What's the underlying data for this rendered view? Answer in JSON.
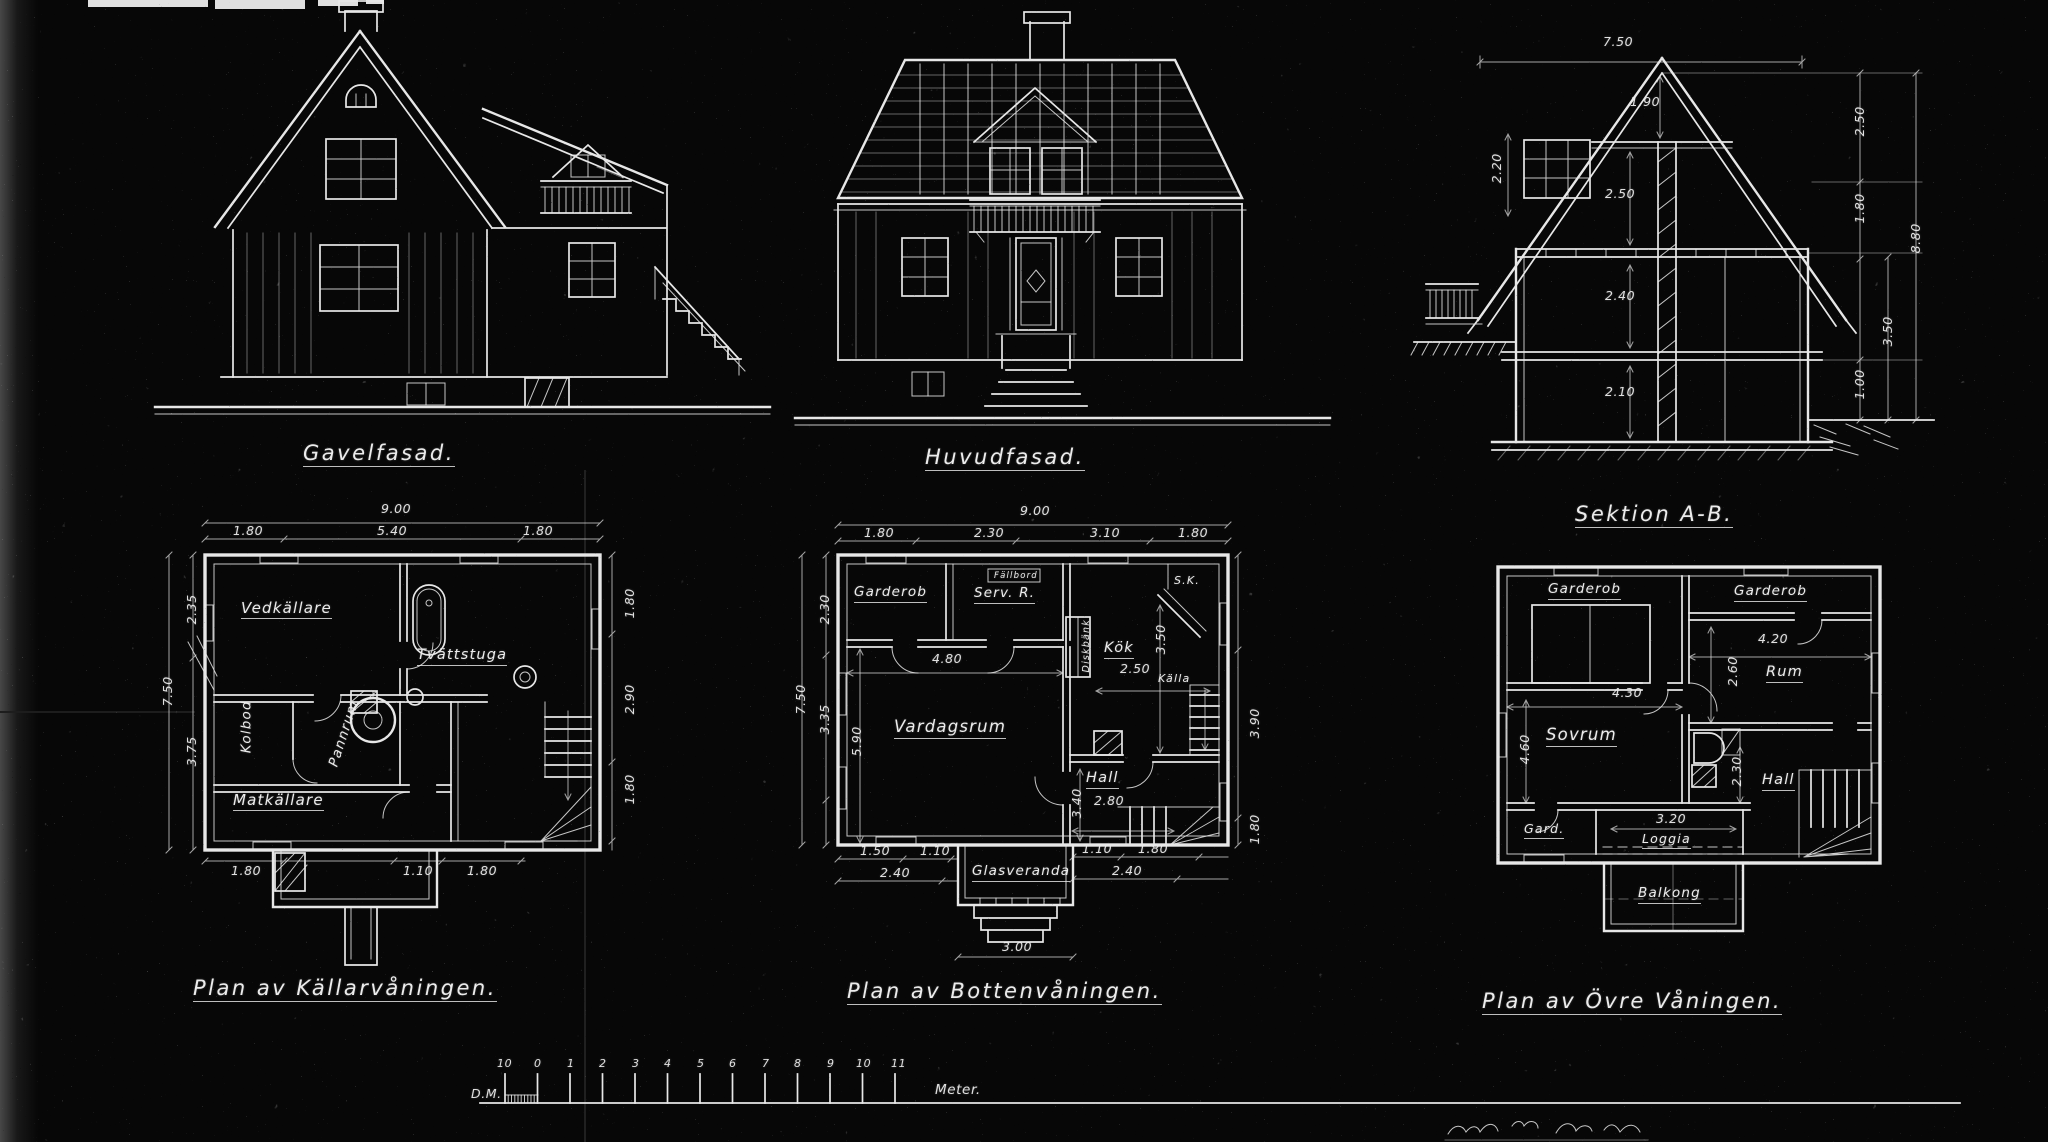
{
  "meta": {
    "description": "Scanned architectural blueprint, photographic negative (white line work on black paper)",
    "ink_color": "#e7e7e7",
    "paper_color": "#070707"
  },
  "elevations": {
    "gavelfasad": {
      "title": "Gavelfasad."
    },
    "huvudfasad": {
      "title": "Huvudfasad."
    },
    "sektion": {
      "title": "Sektion A-B.",
      "dims": {
        "top": "7.50",
        "ridge": "1.90",
        "attic": "2.50",
        "left": "2.20",
        "floor1": "2.40",
        "cellar": "2.10",
        "r1": "2.50",
        "r2": "1.80",
        "r3": "1.00",
        "r4": "3.50",
        "total": "8.80"
      }
    }
  },
  "plans": {
    "cellar": {
      "title": "Plan av Källarvåningen.",
      "rooms": {
        "vedkallare": "Vedkällare",
        "tvattstuga": "Tvättstuga",
        "kolbod": "Kolbod",
        "pannrum": "Pannrum",
        "matkallare": "Matkällare"
      },
      "dims": {
        "w": "9.00",
        "w1": "1.80",
        "w2": "5.40",
        "w3": "1.80",
        "h": "7.50",
        "l1": "2.35",
        "l2": "3.75",
        "r1": "1.80",
        "r2": "2.90",
        "r3": "1.80",
        "b1": "1.80",
        "b2": "1.10",
        "b3": "1.80"
      }
    },
    "ground": {
      "title": "Plan av Bottenvåningen.",
      "rooms": {
        "garderob": "Garderob",
        "serv": "Serv. R.",
        "sk": "S.K.",
        "kok": "Kök",
        "vardagsrum": "Vardagsrum",
        "hall": "Hall",
        "kalla": "Källa",
        "glasveranda": "Glasveranda",
        "diskbank": "Diskbänk",
        "fallbord": "Fällbord"
      },
      "dims": {
        "w": "9.00",
        "t1": "1.80",
        "t2": "2.30",
        "t3": "3.10",
        "t4": "1.80",
        "vard_w": "4.80",
        "vard_h": "5.90",
        "kok": "2.50",
        "kok_h": "3.50",
        "hall_w": "2.80",
        "hall_h": "3.40",
        "l1": "2.30",
        "l2": "3.35",
        "h": "7.50",
        "r1": "3.90",
        "r2": "1.80",
        "b1": "1.50",
        "b2": "1.10",
        "b3": "2.40",
        "b4": "1.10",
        "b5": "1.80",
        "b6": "2.40",
        "veranda": "3.00"
      }
    },
    "upper": {
      "title": "Plan av Övre Våningen.",
      "rooms": {
        "garderob1": "Garderob",
        "garderob2": "Garderob",
        "rum": "Rum",
        "sovrum": "Sovrum",
        "hall": "Hall",
        "gard": "Gard.",
        "loggia": "Loggia",
        "balkong": "Balkong"
      },
      "dims": {
        "rum_w": "4.20",
        "rum_h": "2.60",
        "sov_w": "4.30",
        "sov_h": "4.60",
        "hall_h": "2.30",
        "loggia_w": "3.20"
      }
    }
  },
  "scale_bar": {
    "dm": "D.M.",
    "meter": "Meter.",
    "ticks": [
      "10",
      "0",
      "1",
      "2",
      "3",
      "4",
      "5",
      "6",
      "7",
      "8",
      "9",
      "10",
      "11"
    ]
  }
}
